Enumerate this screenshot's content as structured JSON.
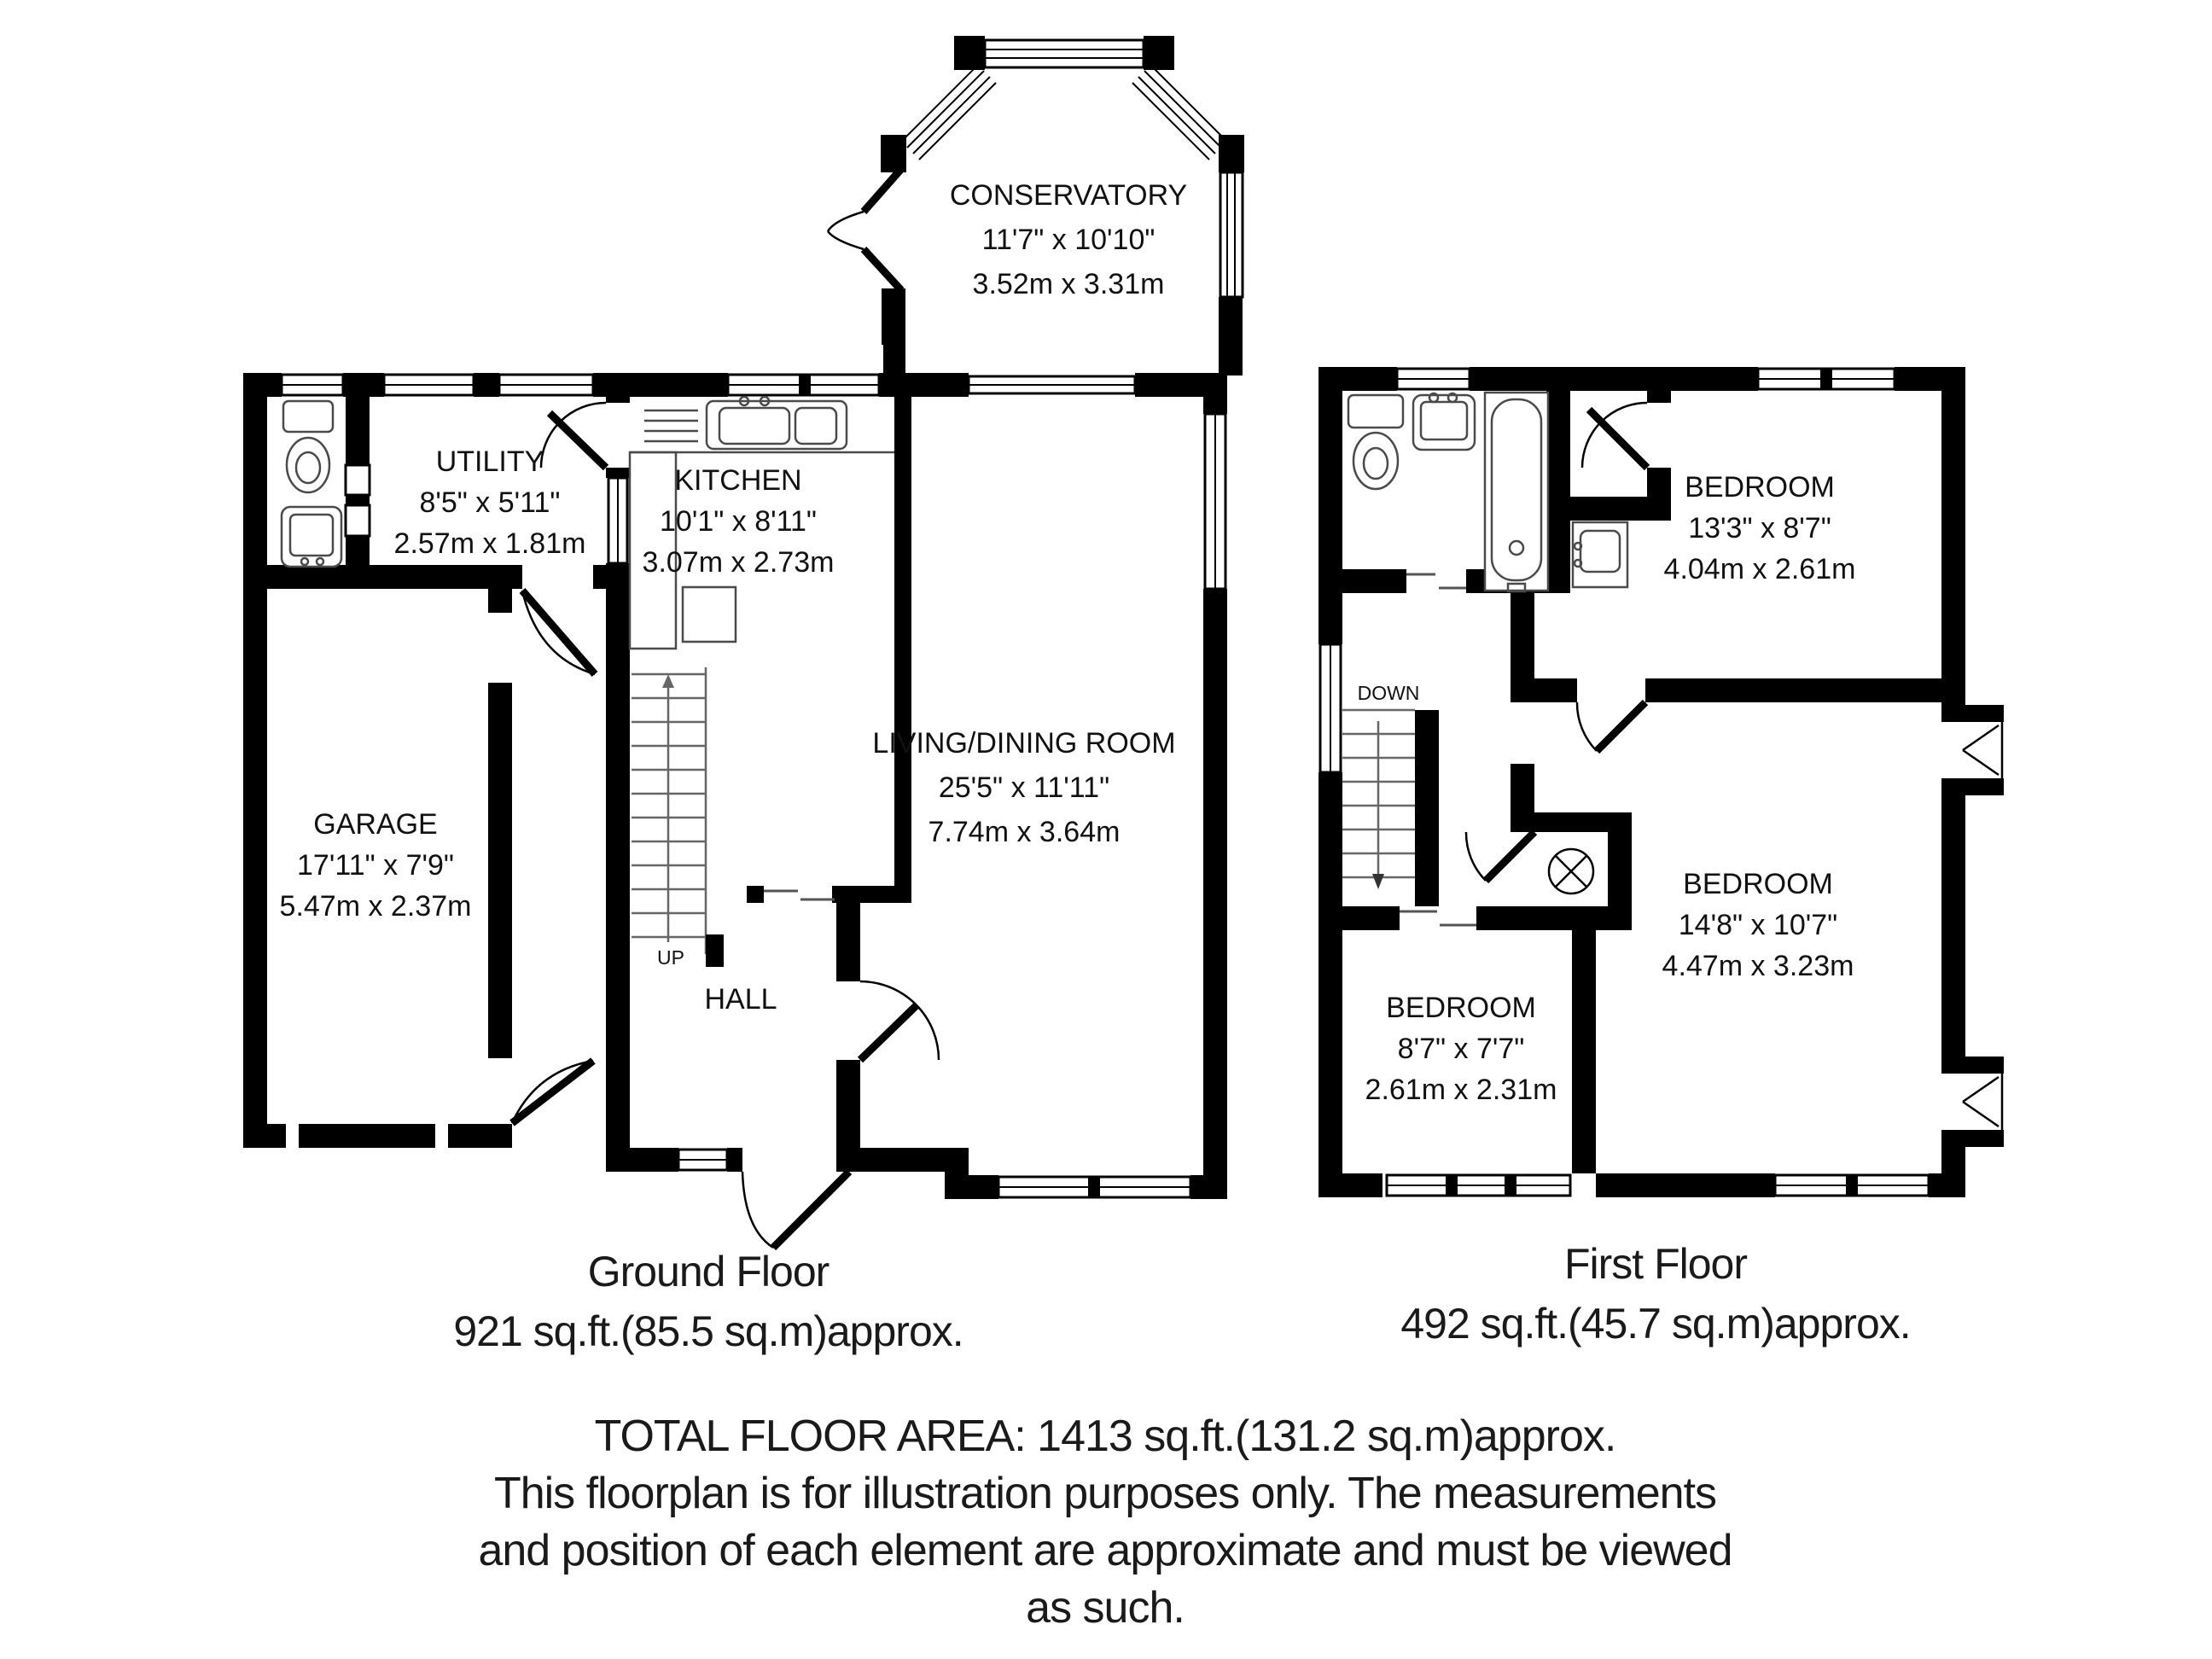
{
  "colors": {
    "wall": "#000000",
    "fixture": "#4a4a4a",
    "background": "#ffffff"
  },
  "ground_floor": {
    "caption_title": "Ground Floor",
    "caption_area": "921 sq.ft.(85.5 sq.m)approx.",
    "conservatory_name": "CONSERVATORY",
    "conservatory_imperial": "11'7\" x 10'10\"",
    "conservatory_metric": "3.52m x 3.31m",
    "utility_name": "UTILITY",
    "utility_imperial": "8'5\" x 5'11\"",
    "utility_metric": "2.57m x 1.81m",
    "kitchen_name": "KITCHEN",
    "kitchen_imperial": "10'1\" x 8'11\"",
    "kitchen_metric": "3.07m x 2.73m",
    "garage_name": "GARAGE",
    "garage_imperial": "17'11\" x 7'9\"",
    "garage_metric": "5.47m x 2.37m",
    "living_name": "LIVING/DINING ROOM",
    "living_imperial": "25'5\" x 11'11\"",
    "living_metric": "7.74m x 3.64m",
    "hall_name": "HALL",
    "up_label": "UP"
  },
  "first_floor": {
    "caption_title": "First Floor",
    "caption_area": "492 sq.ft.(45.7 sq.m)approx.",
    "bedroom1_name": "BEDROOM",
    "bedroom1_imperial": "13'3\" x 8'7\"",
    "bedroom1_metric": "4.04m x 2.61m",
    "bedroom2_name": "BEDROOM",
    "bedroom2_imperial": "14'8\" x 10'7\"",
    "bedroom2_metric": "4.47m x 3.23m",
    "bedroom3_name": "BEDROOM",
    "bedroom3_imperial": "8'7\" x 7'7\"",
    "bedroom3_metric": "2.61m x 2.31m",
    "down_label": "DOWN"
  },
  "footer": {
    "total_area": "TOTAL FLOOR AREA: 1413 sq.ft.(131.2 sq.m)approx.",
    "disclaimer_line1": "This floorplan is for illustration purposes only. The measurements",
    "disclaimer_line2": "and position of each element are approximate and must be viewed",
    "disclaimer_line3": "as such."
  }
}
